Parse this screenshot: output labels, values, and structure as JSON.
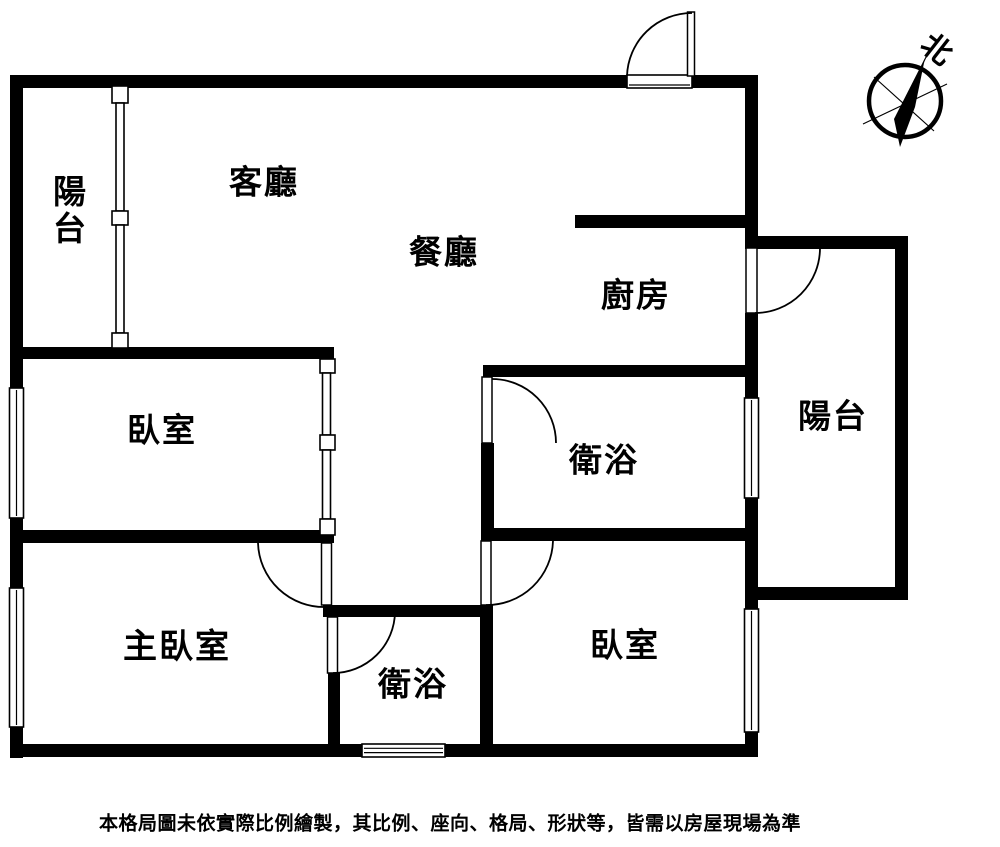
{
  "plan": {
    "rooms": {
      "balcony_left": {
        "label": "陽台"
      },
      "living_room": {
        "label": "客廳"
      },
      "dining_room": {
        "label": "餐廳"
      },
      "kitchen": {
        "label": "廚房"
      },
      "balcony_right": {
        "label": "陽台"
      },
      "bathroom_upper": {
        "label": "衛浴"
      },
      "bedroom_left": {
        "label": "臥室"
      },
      "master_bedroom": {
        "label": "主臥室"
      },
      "bathroom_lower": {
        "label": "衛浴"
      },
      "bedroom_right": {
        "label": "臥室"
      }
    },
    "compass": {
      "north_label": "北"
    },
    "disclaimer": "本格局圖未依實際比例繪製，其比例、座向、格局、形狀等，皆需以房屋現場為準",
    "colors": {
      "wall": "#000000",
      "background": "#ffffff",
      "line": "#000000"
    }
  }
}
